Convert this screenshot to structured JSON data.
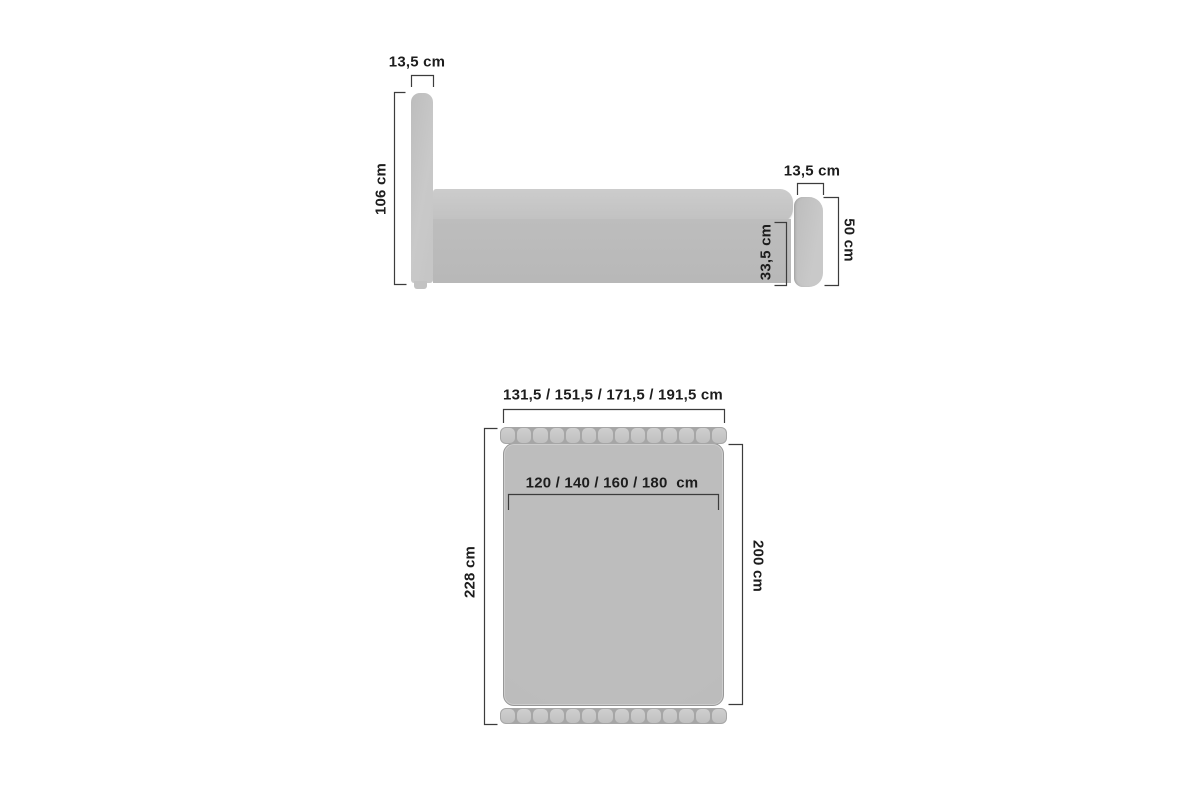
{
  "diagram": {
    "type": "furniture-dimension-drawing",
    "subject": "upholstered bed with headboard and footboard",
    "unit": "cm",
    "background_color": "#ffffff",
    "line_color": "#3c3c3c",
    "text_color": "#1d1d1d",
    "furniture_fill": "#bdbdbd",
    "furniture_fill_light": "#cccccc"
  },
  "side_view": {
    "name": "side view",
    "labels": {
      "headboard_thickness": "13,5 cm",
      "headboard_height": "106 cm",
      "footboard_thickness": "13,5 cm",
      "footboard_height": "50 cm",
      "base_height": "33,5 cm"
    }
  },
  "top_view": {
    "name": "top view",
    "strip_segments": 14,
    "labels": {
      "overall_width_options": "131,5 / 151,5 / 171,5 / 191,5 cm",
      "mattress_width_options": "120 / 140 / 160 / 180  cm",
      "overall_length": "228 cm",
      "mattress_length": "200 cm"
    }
  }
}
